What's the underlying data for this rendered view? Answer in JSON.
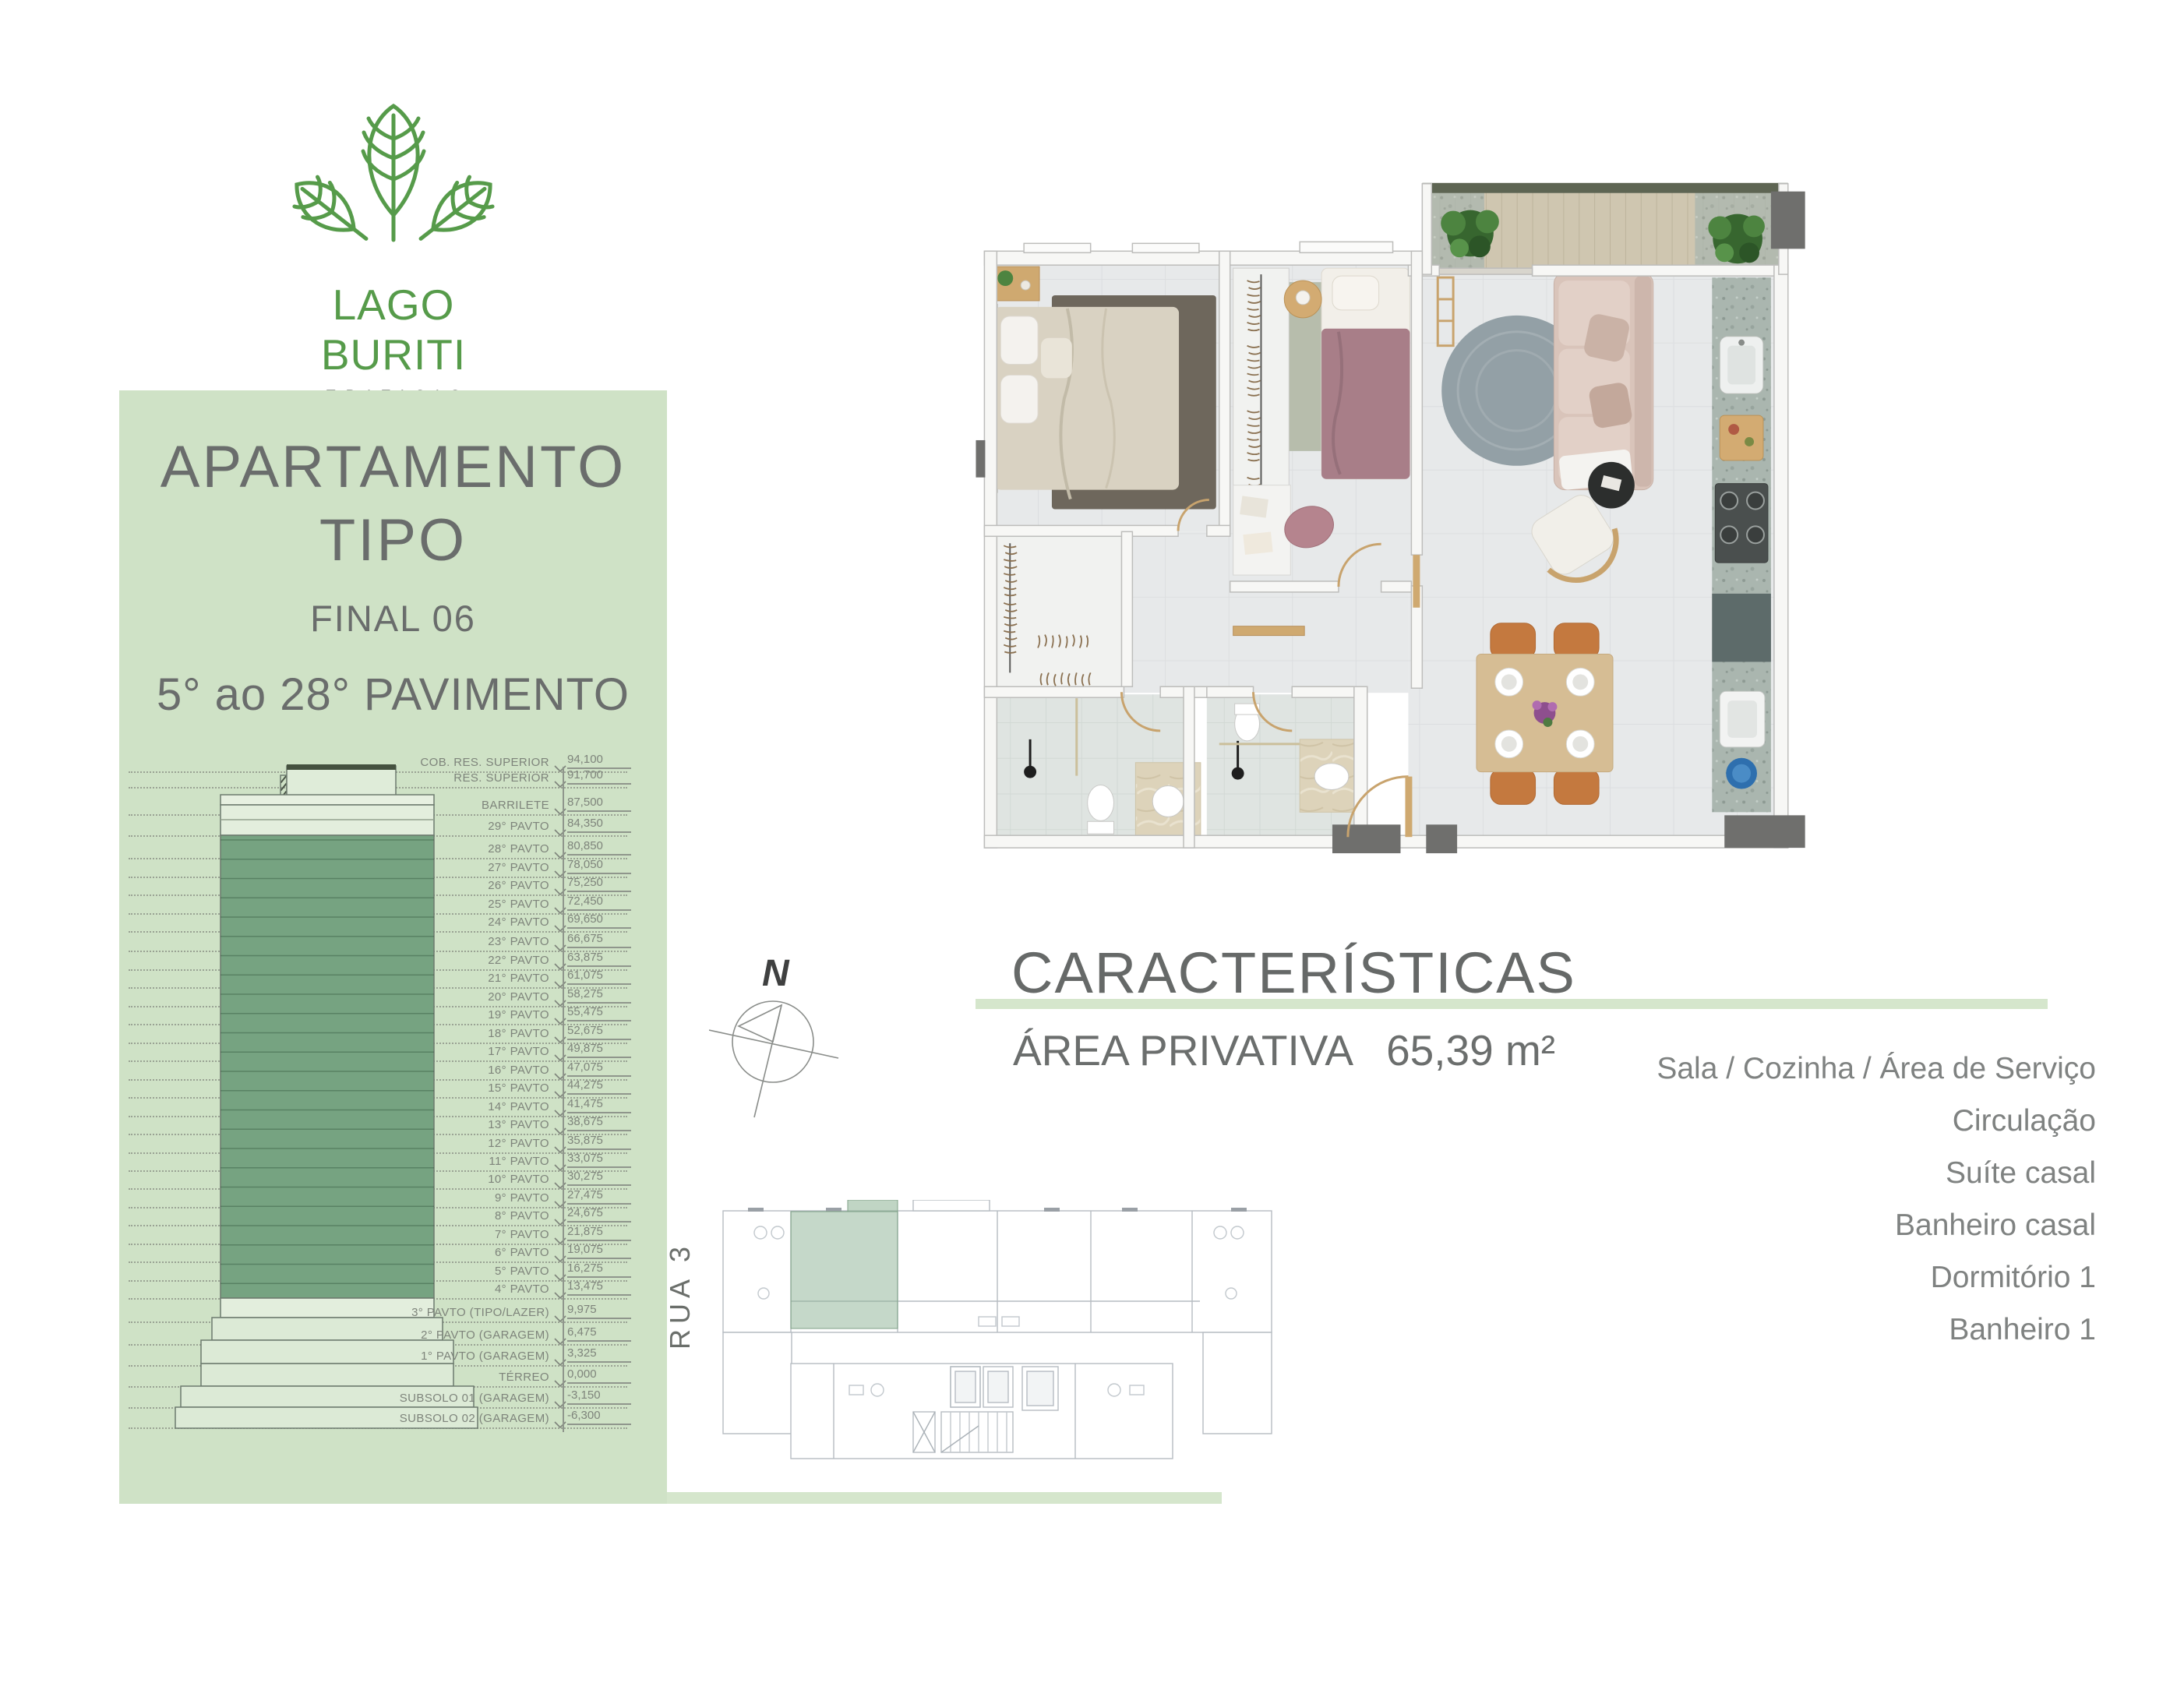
{
  "logo": {
    "brand": "LAGO BURITI",
    "subtitle": "EDIFICIO"
  },
  "left_panel": {
    "title_line1": "APARTAMENTO",
    "title_line2": "TIPO",
    "final": "FINAL 06",
    "floors_range": "5° ao 28° PAVIMENTO"
  },
  "elevation": {
    "levels": [
      {
        "label": "COB. RES. SUPERIOR",
        "value": "94,100"
      },
      {
        "label": "RES. SUPERIOR",
        "value": "91,700"
      },
      {
        "label": "BARRILETE",
        "value": "87,500"
      },
      {
        "label": "29° PAVTO",
        "value": "84,350"
      },
      {
        "label": "28° PAVTO",
        "value": "80,850"
      },
      {
        "label": "27° PAVTO",
        "value": "78,050"
      },
      {
        "label": "26° PAVTO",
        "value": "75,250"
      },
      {
        "label": "25° PAVTO",
        "value": "72,450"
      },
      {
        "label": "24° PAVTO",
        "value": "69,650"
      },
      {
        "label": "23° PAVTO",
        "value": "66,675"
      },
      {
        "label": "22° PAVTO",
        "value": "63,875"
      },
      {
        "label": "21° PAVTO",
        "value": "61,075"
      },
      {
        "label": "20° PAVTO",
        "value": "58,275"
      },
      {
        "label": "19° PAVTO",
        "value": "55,475"
      },
      {
        "label": "18° PAVTO",
        "value": "52,675"
      },
      {
        "label": "17° PAVTO",
        "value": "49,875"
      },
      {
        "label": "16° PAVTO",
        "value": "47,075"
      },
      {
        "label": "15° PAVTO",
        "value": "44,275"
      },
      {
        "label": "14° PAVTO",
        "value": "41,475"
      },
      {
        "label": "13° PAVTO",
        "value": "38,675"
      },
      {
        "label": "12° PAVTO",
        "value": "35,875"
      },
      {
        "label": "11° PAVTO",
        "value": "33,075"
      },
      {
        "label": "10° PAVTO",
        "value": "30,275"
      },
      {
        "label": "9° PAVTO",
        "value": "27,475"
      },
      {
        "label": "8° PAVTO",
        "value": "24,675"
      },
      {
        "label": "7° PAVTO",
        "value": "21,875"
      },
      {
        "label": "6° PAVTO",
        "value": "19,075"
      },
      {
        "label": "5° PAVTO",
        "value": "16,275"
      },
      {
        "label": "4° PAVTO",
        "value": "13,475"
      },
      {
        "label": "3° PAVTO (TIPO/LAZER)",
        "value": "9,975"
      },
      {
        "label": "2° PAVTO (GARAGEM)",
        "value": "6,475"
      },
      {
        "label": "1° PAVTO (GARAGEM)",
        "value": "3,325"
      },
      {
        "label": "TÉRREO",
        "value": "0,000"
      },
      {
        "label": "SUBSOLO 01 (GARAGEM)",
        "value": "-3,150"
      },
      {
        "label": "SUBSOLO 02 (GARAGEM)",
        "value": "-6,300"
      }
    ]
  },
  "compass": {
    "north_label": "N"
  },
  "characteristics": {
    "title": "CARACTERÍSTICAS",
    "area_label": "ÁREA PRIVATIVA",
    "area_value": "65,39 m²",
    "rooms": [
      "Sala / Cozinha / Área de Serviço",
      "Circulação",
      "Suíte casal",
      "Banheiro casal",
      "Dormitório 1",
      "Banheiro 1"
    ]
  },
  "key_plan": {
    "street_label": "RUA 3"
  },
  "colors": {
    "panelGreen": "#cfe2c6",
    "accentGreen": "#d5e6cc",
    "towerGreen": "#76a381",
    "logoGreen": "#569b4a",
    "textGray": "#6a6d6c",
    "listGray": "#7f8281",
    "elevGray": "#7e847b",
    "highlightGreen": "#9db8a3",
    "darkLabel": "#3f4040"
  }
}
